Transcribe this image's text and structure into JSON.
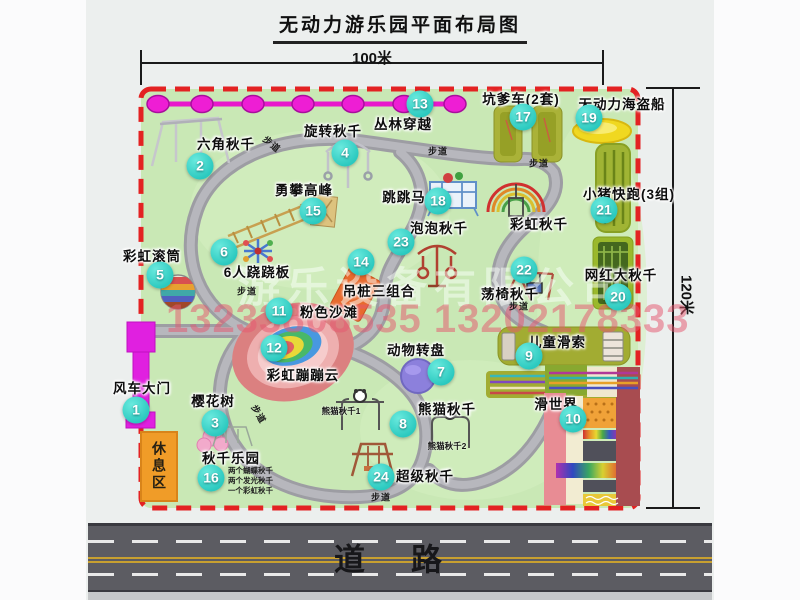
{
  "title": "无动力游乐园平面布局图",
  "dim_top": "100米",
  "dim_right": "120米",
  "road_label": "道路",
  "path_label": "步道",
  "rest_area": "休息区",
  "watermark_company": "游乐设备有限公司",
  "watermark_phone": "13233808535 13202178333",
  "colors": {
    "badge_teal": "#2bc9bf",
    "park_green": "#c9e8b5",
    "border_red": "#e32222",
    "zipline_magenta": "#e818cc",
    "gate_magenta": "#e020e0",
    "rest_orange": "#f09c28"
  },
  "facilities": [
    {
      "num": "1",
      "name": "风车大门"
    },
    {
      "num": "2",
      "name": "六角秋千"
    },
    {
      "num": "3",
      "name": "樱花树"
    },
    {
      "num": "4",
      "name": "旋转秋千"
    },
    {
      "num": "5",
      "name": "彩虹滚筒"
    },
    {
      "num": "6",
      "name": "6人跷跷板"
    },
    {
      "num": "7",
      "name": "动物转盘"
    },
    {
      "num": "8",
      "name": "熊猫秋千"
    },
    {
      "num": "9",
      "name": "儿童滑索"
    },
    {
      "num": "10",
      "name": "滑世界"
    },
    {
      "num": "11",
      "name": "粉色沙滩"
    },
    {
      "num": "12",
      "name": "彩虹蹦蹦云"
    },
    {
      "num": "13",
      "name": "丛林穿越"
    },
    {
      "num": "14",
      "name": "吊桩三组合"
    },
    {
      "num": "15",
      "name": "勇攀高峰"
    },
    {
      "num": "16",
      "name": "秋千乐园"
    },
    {
      "num": "17",
      "name": "坑爹车(2套)"
    },
    {
      "num": "18",
      "name": "跳跳马"
    },
    {
      "num": "19",
      "name": "无动力海盗船"
    },
    {
      "num": "20",
      "name": "网红大秋千"
    },
    {
      "num": "21",
      "name": "小猪快跑(3组)"
    },
    {
      "num": "22",
      "name": "荡椅秋千"
    },
    {
      "num": "23",
      "name": "泡泡秋千"
    },
    {
      "num": "24",
      "name": "超级秋千"
    },
    {
      "num": "",
      "name": "彩虹秋千"
    }
  ],
  "panda_sub1": "熊猫秋千1",
  "panda_sub2": "熊猫秋千2",
  "swing_park_lines": [
    "两个蝴蝶秋千",
    "两个发光秋千",
    "一个彩虹秋千"
  ]
}
